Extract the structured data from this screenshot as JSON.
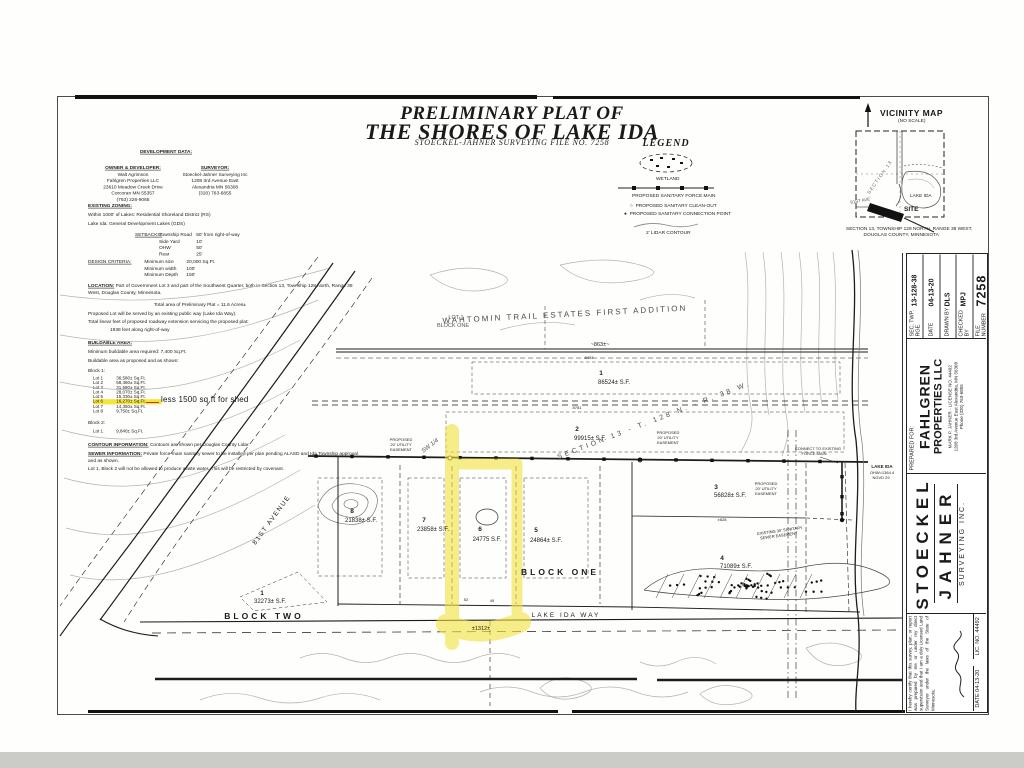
{
  "title": {
    "line1": "PRELIMINARY PLAT OF",
    "line2": "THE SHORES OF LAKE IDA",
    "subtitle": "STOECKEL-JAHNER SURVEYING FILE NO. 7258"
  },
  "development": {
    "heading": "DEVELOPMENT DATA:",
    "owner": {
      "title": "OWNER & DEVELOPER:",
      "lines": [
        "Walt Agrimson",
        "Fahlgren Properties LLC",
        "23610 Meadow Creek Drive",
        "Corcoran MN 55357",
        "(763) 226-9065"
      ]
    },
    "surveyor": {
      "title": "SURVEYOR:",
      "lines": [
        "Stoeckel-Jahner Surveying Inc",
        "1208 3rd Avenue East",
        "Alexandria MN 56308",
        "(320) 763-6855"
      ]
    },
    "zoning": {
      "heading": "EXISTING ZONING:",
      "line1": "Within 1000' of Lakes:  Residential Shoreland District (RS)",
      "line2": "Lake Ida:  General Development Lakes (GDS)"
    },
    "setbacks": {
      "label": "SETBACKS:",
      "rows": [
        {
          "name": "Township Road",
          "value": "50' from right-of-way"
        },
        {
          "name": "Side Yard",
          "value": "10'"
        },
        {
          "name": "OHW",
          "value": "50'"
        },
        {
          "name": "Rear",
          "value": "25'"
        }
      ]
    },
    "design": {
      "label": "DESIGN CRITERIA:",
      "rows": [
        {
          "name": "Minimum size",
          "value": "20,000 Sq.Ft."
        },
        {
          "name": "Minimum width",
          "value": "100'"
        },
        {
          "name": "Minimum Depth",
          "value": "150'"
        }
      ]
    },
    "location": {
      "label": "LOCATION:",
      "text": "Part of Government Lot 3 and part of the Southwest Quarter, both in Section 13, Township 128 North, Range 38 West, Douglas County, Minnesota."
    },
    "area_note": "Total area of Preliminary Plat = 11.6 Acres±",
    "served_note": "Proposed Lot will be served by an existing public way (Lake Ida Way).",
    "roadway_note": "Total linear feet of proposed roadway extension servicing the proposed plat:",
    "roadway_value": "1938 feet along right-of-way",
    "buildable": {
      "heading": "BUILDABLE AREA:",
      "required": "Minimum buildable area required:  7,400 Sq.Ft.",
      "shown": "Buildable area as proposed and as shown:"
    },
    "block1_label": "Block 1:",
    "block1_lots": [
      {
        "lot": "Lot 1",
        "area": "36,580± Sq.Ft.",
        "highlight": false
      },
      {
        "lot": "Lot 2",
        "area": "58,360± Sq.Ft.",
        "highlight": false
      },
      {
        "lot": "Lot 3",
        "area": "31,580± Sq.Ft.",
        "highlight": false
      },
      {
        "lot": "Lot 4",
        "area": "28,070± Sq.Ft.",
        "highlight": false
      },
      {
        "lot": "Lot 5",
        "area": "15,330± Sq.Ft.",
        "highlight": false
      },
      {
        "lot": "Lot 6",
        "area": "16,270± Sq.Ft.",
        "highlight": true
      },
      {
        "lot": "Lot 7",
        "area": "14,350± Sq.Ft.",
        "highlight": false
      },
      {
        "lot": "Lot 8",
        "area": "9,750± Sq.Ft.",
        "highlight": false
      }
    ],
    "block2_label": "Block 2:",
    "block2_lots": [
      {
        "lot": "Lot 1",
        "area": "9,840± Sq.Ft.",
        "highlight": false
      }
    ],
    "contour": {
      "label": "CONTOUR INFORMATION:",
      "text": "Contours are shown per Douglas County Lidar."
    },
    "sewer": {
      "label": "SEWER INFORMATION:",
      "text": "Private force-main sanitary sewer to be installed per plan pending ALASD and Ida Township approval and as shown."
    },
    "covenant_note": "Lot 1, Block 2 will not be allowed to produce waste water. This will be restricted by covenant.",
    "annotation": "less 1500 sq ft for shed"
  },
  "legend": {
    "title": "LEGEND",
    "wetland_label": "WETLAND",
    "force_main_label": "PROPOSED SANITARY FORCE MAIN",
    "cleanout_label": "PROPOSED SANITARY CLEAN-OUT",
    "connection_label": "PROPOSED SANITARY CONNECTION POINT",
    "contour_label": "2' LIDAR CONTOUR"
  },
  "vicinity": {
    "title": "VICINITY MAP",
    "noscale": "(NO SCALE)",
    "lake": "LAKE IDA",
    "site": "SITE",
    "section": "SECTION 13",
    "avenue": "81ST AVE",
    "caption1": "SECTION 13, TOWNSHIP 128 NORTH, RANGE 38 WEST,",
    "caption2": "DOUGLAS COUNTY, MINNESOTA"
  },
  "title_block": {
    "info": [
      {
        "label": "SEC. TWP. RGE.",
        "value": "13-128-38"
      },
      {
        "label": "DATE",
        "value": "04-13-20"
      },
      {
        "label": "DRAWN BY",
        "value": "DLS"
      },
      {
        "label": "CHECKED BY",
        "value": "MPJ"
      },
      {
        "label": "FILE NUMBER",
        "value": "7258"
      }
    ],
    "prepared": "PREPARED FOR:",
    "client1": "FAHLGREN",
    "client2": "PROPERTIES LLC",
    "license": "MARK P. JAHNER - LICENSE NO. 44492",
    "addr1": "1208 3rd Avenue East   Alexandria, MN 56308",
    "addr2": "Phone (320) 763-6855",
    "firm1": "STOECKEL",
    "firm2": "JAHNER",
    "firm3": "SURVEYING INC.",
    "certification": "I hereby certify that this survey, plan, or report was prepared by me or under my direct supervision and that I am a duly Licensed Land Surveyor under the laws of the State of Minnesota.",
    "date_label": "DATE  04-13-20",
    "lic_label": "LIC. NO.  44492"
  },
  "plat": {
    "labels": [
      {
        "t": "WAHTOMIN  TRAIL  ESTATES  FIRST  ADDITION",
        "x": 565,
        "y": 317,
        "s": 8,
        "r": -3,
        "ls": 2,
        "c": "#4a4a4a"
      },
      {
        "t": "LOT 1",
        "x": 456,
        "y": 319,
        "s": 5.5,
        "c": "#555555"
      },
      {
        "t": "BLOCK ONE",
        "x": 453,
        "y": 327,
        "s": 5.5,
        "c": "#555555"
      },
      {
        "t": "~863±~",
        "x": 600,
        "y": 346,
        "s": 5.5
      },
      {
        "t": "8492",
        "x": 589,
        "y": 359,
        "s": 4
      },
      {
        "t": "1",
        "x": 601,
        "y": 375,
        "s": 6.5,
        "w": 1
      },
      {
        "t": "86524± S.F.",
        "x": 614,
        "y": 384,
        "s": 6
      },
      {
        "t": "8781",
        "x": 577,
        "y": 409,
        "s": 4
      },
      {
        "t": "2",
        "x": 577,
        "y": 431,
        "s": 6.5,
        "w": 1
      },
      {
        "t": "99915± S.F.",
        "x": 590,
        "y": 440,
        "s": 6
      },
      {
        "t": "SECTION 13 - T. 128 N. - R. 38 W.",
        "x": 655,
        "y": 422,
        "s": 7,
        "r": -21,
        "ls": 3,
        "c": "#4a4a4a"
      },
      {
        "t": "SW 1/4",
        "x": 431,
        "y": 447,
        "s": 6,
        "r": -38,
        "i": 1,
        "c": "#4a4a4a"
      },
      {
        "t": "PROPOSED",
        "x": 401,
        "y": 441,
        "s": 4
      },
      {
        "t": "20' UTILITY",
        "x": 401,
        "y": 446,
        "s": 4
      },
      {
        "t": "EASEMENT",
        "x": 401,
        "y": 451,
        "s": 4
      },
      {
        "t": "PROPOSED",
        "x": 668,
        "y": 434,
        "s": 4
      },
      {
        "t": "20' UTILITY",
        "x": 668,
        "y": 439,
        "s": 4
      },
      {
        "t": "EASEMENT",
        "x": 668,
        "y": 444,
        "s": 4
      },
      {
        "t": "PROPOSED",
        "x": 766,
        "y": 485,
        "s": 4
      },
      {
        "t": "20' UTILITY",
        "x": 766,
        "y": 490,
        "s": 4
      },
      {
        "t": "EASEMENT",
        "x": 766,
        "y": 495,
        "s": 4
      },
      {
        "t": "3",
        "x": 716,
        "y": 489,
        "s": 6.5,
        "w": 1
      },
      {
        "t": "56828± S.F.",
        "x": 730,
        "y": 497,
        "s": 6
      },
      {
        "t": "±628",
        "x": 722,
        "y": 521,
        "s": 4
      },
      {
        "t": "4",
        "x": 722,
        "y": 560,
        "s": 6.5,
        "w": 1
      },
      {
        "t": "71089± S.F.",
        "x": 736,
        "y": 568,
        "s": 6
      },
      {
        "t": "5",
        "x": 536,
        "y": 532,
        "s": 6.5,
        "w": 1
      },
      {
        "t": "24864± S.F.",
        "x": 546,
        "y": 542,
        "s": 6
      },
      {
        "t": "6",
        "x": 480,
        "y": 531,
        "s": 6.5,
        "w": 1
      },
      {
        "t": "24775 S.F.",
        "x": 487,
        "y": 541,
        "s": 6
      },
      {
        "t": "7",
        "x": 424,
        "y": 522,
        "s": 6.5,
        "w": 1
      },
      {
        "t": "23858± S.F.",
        "x": 433,
        "y": 531,
        "s": 6
      },
      {
        "t": "8",
        "x": 352,
        "y": 513,
        "s": 6.5,
        "w": 1
      },
      {
        "t": "21838± S.F.",
        "x": 361,
        "y": 522,
        "s": 6
      },
      {
        "t": "BLOCK  ONE",
        "x": 560,
        "y": 575,
        "s": 8.5,
        "w": 1,
        "ls": 3
      },
      {
        "t": "1",
        "x": 262,
        "y": 595,
        "s": 6.5,
        "w": 1
      },
      {
        "t": "32273± S.F.",
        "x": 270,
        "y": 603,
        "s": 6
      },
      {
        "t": "BLOCK  TWO",
        "x": 264,
        "y": 619,
        "s": 8.5,
        "w": 1,
        "ls": 3
      },
      {
        "t": "81ST  AVENUE",
        "x": 273,
        "y": 521,
        "s": 6.5,
        "r": -54,
        "ls": 1.5
      },
      {
        "t": "LAKE  IDA  WAY",
        "x": 566,
        "y": 617,
        "s": 6.5,
        "ls": 2
      },
      {
        "t": "±1312±",
        "x": 481,
        "y": 630,
        "s": 5.5
      },
      {
        "t": "52",
        "x": 466,
        "y": 601,
        "s": 4
      },
      {
        "t": "49",
        "x": 492,
        "y": 602,
        "s": 4
      },
      {
        "t": "EXISTING 30' SANITARY",
        "x": 780,
        "y": 532,
        "s": 4,
        "r": -8
      },
      {
        "t": "SEWER EASEMENT",
        "x": 779,
        "y": 537,
        "s": 4,
        "r": -8
      },
      {
        "t": "CONNECT TO EXISTING",
        "x": 818,
        "y": 450,
        "s": 4
      },
      {
        "t": "FORCE MAIN",
        "x": 814,
        "y": 455,
        "s": 4
      },
      {
        "t": "LAKE IDA",
        "x": 882,
        "y": 468,
        "s": 4.5,
        "w": 1
      },
      {
        "t": "OHW=1364.4",
        "x": 882,
        "y": 474,
        "s": 4
      },
      {
        "t": "NGVD 29",
        "x": 881,
        "y": 479,
        "s": 4
      },
      {
        "t": "N",
        "x": 508,
        "y": 190,
        "s": 8,
        "w": 1
      },
      {
        "t": "0",
        "x": 468,
        "y": 216,
        "s": 4.5,
        "i": 1
      },
      {
        "t": "50",
        "x": 497,
        "y": 216,
        "s": 4.5,
        "i": 1
      },
      {
        "t": "100",
        "x": 526,
        "y": 216,
        "s": 4.5,
        "i": 1
      },
      {
        "t": "150",
        "x": 555,
        "y": 216,
        "s": 4.5,
        "i": 1
      }
    ]
  }
}
